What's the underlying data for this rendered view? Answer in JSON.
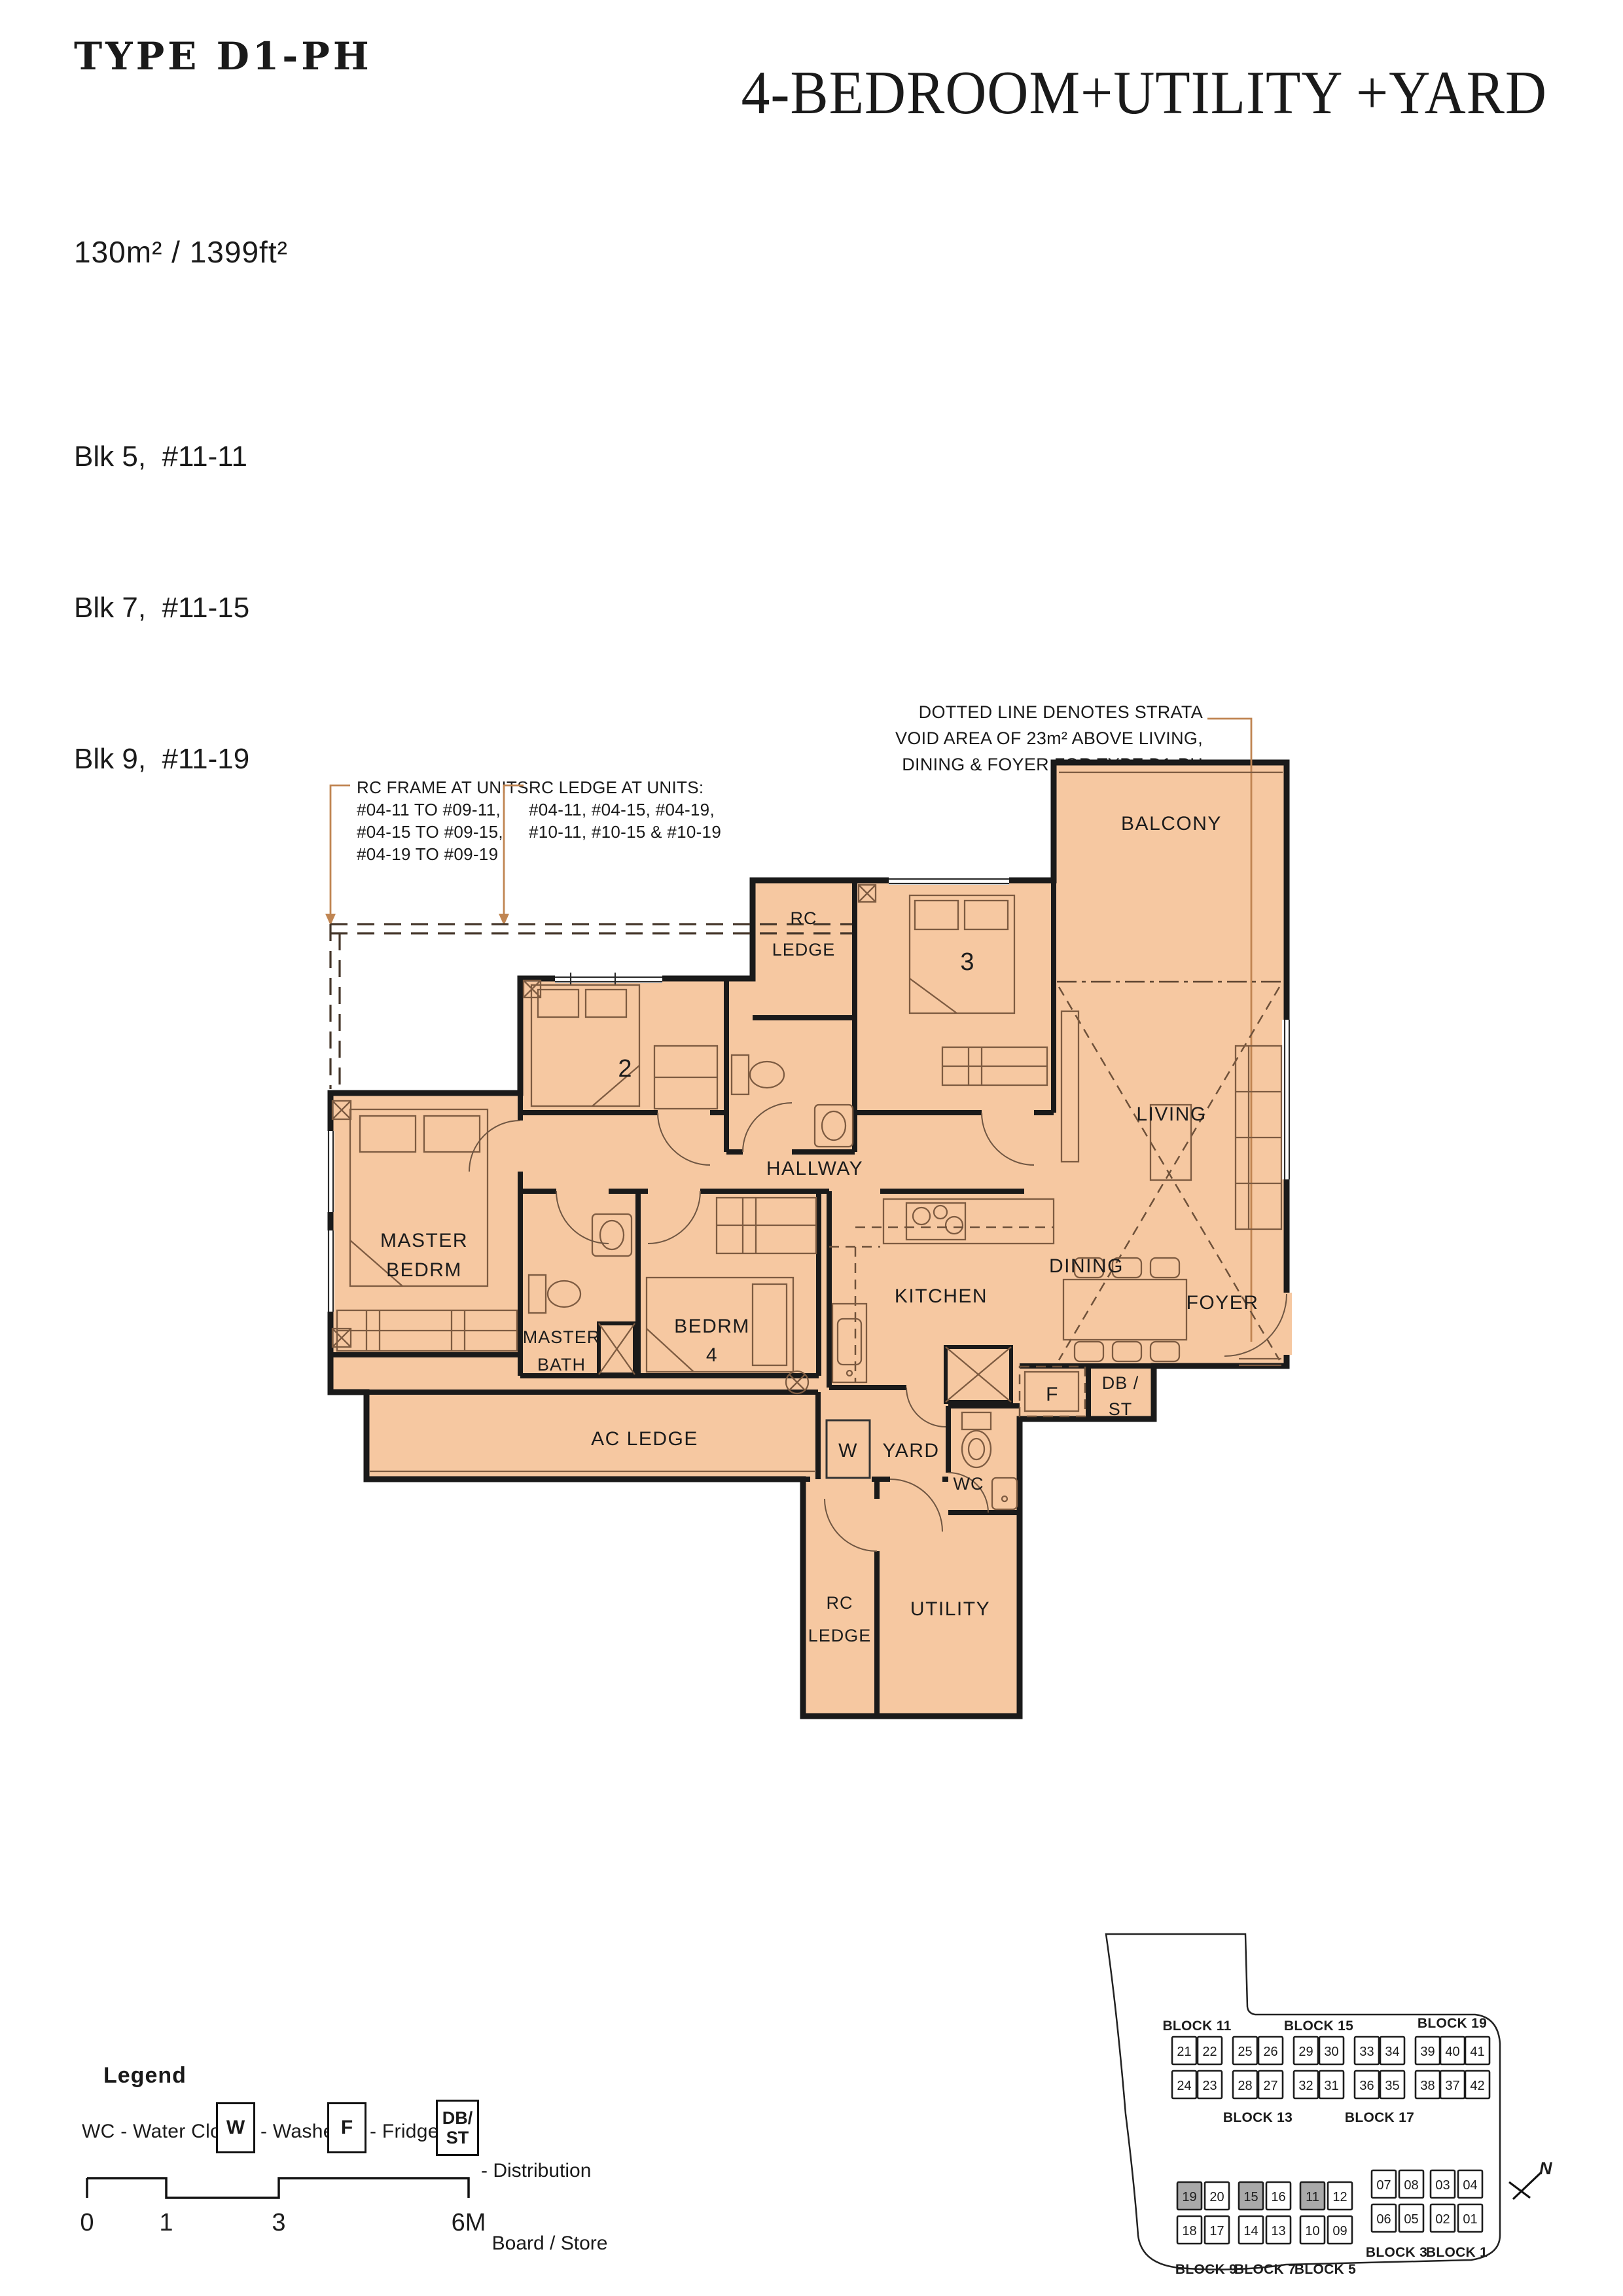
{
  "header": {
    "type_label": "TYPE D1-PH",
    "title": "4-BEDROOM+UTILITY +YARD",
    "area": "130m² / 1399ft²",
    "units": [
      "Blk 5,  #11-11",
      "Blk 7,  #11-15",
      "Blk 9,  #11-19"
    ]
  },
  "notes": {
    "rc_frame": [
      "RC FRAME AT UNITS:",
      "#04-11 TO #09-11,",
      "#04-15 TO #09-15,",
      "#04-19 TO #09-19"
    ],
    "rc_ledge": [
      "RC LEDGE AT UNITS:",
      "#04-11, #04-15, #04-19,",
      "#10-11, #10-15 & #10-19"
    ],
    "strata": [
      "DOTTED LINE DENOTES STRATA",
      "VOID AREA OF 23m² ABOVE LIVING,",
      "DINING & FOYER FOR TYPE D1-PH"
    ]
  },
  "floorplan": {
    "labels": {
      "balcony": "BALCONY",
      "living": "LIVING",
      "dining": "DINING",
      "foyer": "FOYER",
      "hallway": "HALLWAY",
      "kitchen": "KITCHEN",
      "master_l1": "MASTER",
      "master_l2": "BEDRM",
      "bed2": "2",
      "bed3": "3",
      "rc_top_l1": "RC",
      "rc_top_l2": "LEDGE",
      "mbath_l1": "MASTER",
      "mbath_l2": "BATH",
      "bed4_l1": "BEDRM",
      "bed4_l2": "4",
      "ac_ledge": "AC LEDGE",
      "washer": "W",
      "yard": "YARD",
      "wc": "WC",
      "fridge": "F",
      "db_l1": "DB /",
      "db_l2": "ST",
      "rc_bot_l1": "RC",
      "rc_bot_l2": "LEDGE",
      "utility": "UTILITY"
    }
  },
  "legend": {
    "title": "Legend",
    "wc": "WC - Water Closet",
    "w_symbol": "W",
    "w_text": "- Washer",
    "f_symbol": "F",
    "f_text": "- Fridge",
    "db_symbol_l1": "DB/",
    "db_symbol_l2": "ST",
    "db_text_l1": "- Distribution",
    "db_text_l2": "  Board / Store"
  },
  "scalebar": {
    "labels": [
      "0",
      "1",
      "3",
      "6M"
    ]
  },
  "siteplan": {
    "north": "N",
    "upper": {
      "labels_above": [
        "BLOCK 11",
        "BLOCK 15",
        "BLOCK 19"
      ],
      "labels_below": [
        "BLOCK 13",
        "BLOCK 17"
      ],
      "row1": [
        "21",
        "22",
        "25",
        "26",
        "29",
        "30",
        "33",
        "34",
        "39",
        "40",
        "41"
      ],
      "row2": [
        "24",
        "23",
        "28",
        "27",
        "32",
        "31",
        "36",
        "35",
        "38",
        "37",
        "42"
      ]
    },
    "lower_left": {
      "labels": [
        "BLOCK 9",
        "BLOCK 7",
        "BLOCK 5"
      ],
      "row1": [
        "19",
        "20",
        "15",
        "16",
        "11",
        "12"
      ],
      "row2": [
        "18",
        "17",
        "14",
        "13",
        "10",
        "09"
      ],
      "highlighted": [
        "19",
        "15",
        "11"
      ]
    },
    "lower_right": {
      "labels": [
        "BLOCK 3",
        "BLOCK 1"
      ],
      "row1": [
        "07",
        "08",
        "03",
        "04"
      ],
      "row2": [
        "06",
        "05",
        "02",
        "01"
      ]
    }
  },
  "colors": {
    "floor_fill": "#F6C8A1",
    "wall": "#1A1A1A",
    "leader": "#C08552",
    "highlight_unit": "#A9A9A9"
  }
}
